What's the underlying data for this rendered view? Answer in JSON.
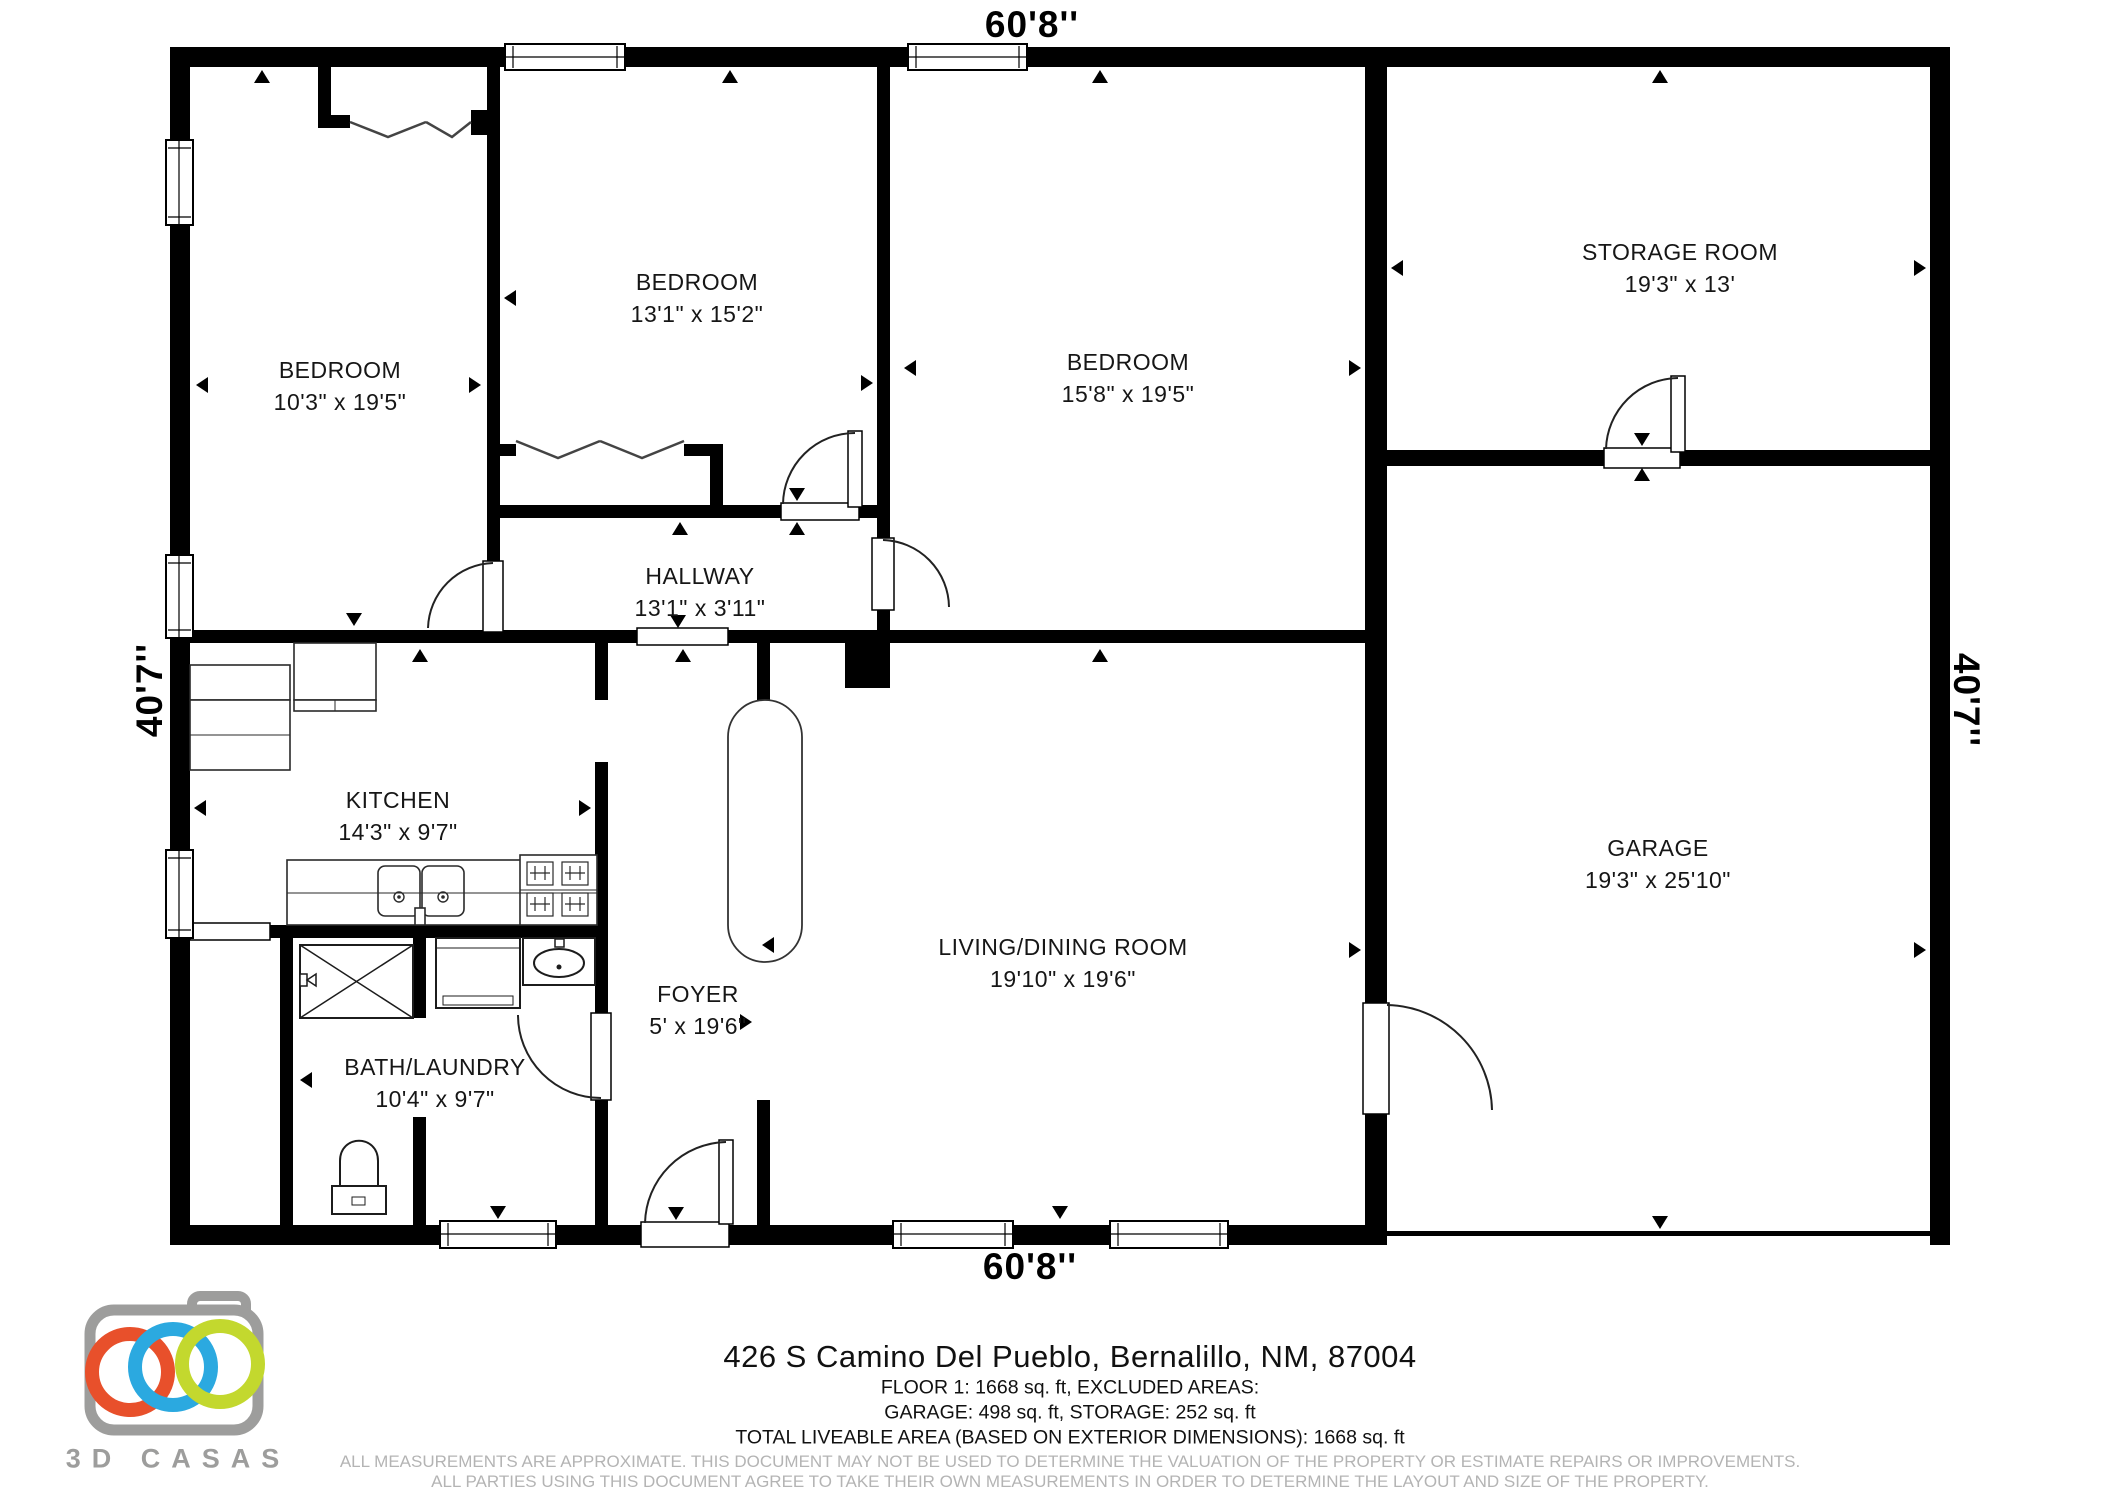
{
  "dimensions": {
    "top": "60'8''",
    "bottom": "60'8''",
    "left": "40'7''",
    "right": "40'7''"
  },
  "rooms": [
    {
      "name": "BEDROOM",
      "dims": "10'3\" x 19'5\""
    },
    {
      "name": "BEDROOM",
      "dims": "13'1\" x 15'2\""
    },
    {
      "name": "BEDROOM",
      "dims": "15'8\" x 19'5\""
    },
    {
      "name": "STORAGE ROOM",
      "dims": "19'3\" x 13'"
    },
    {
      "name": "HALLWAY",
      "dims": "13'1\" x 3'11\""
    },
    {
      "name": "KITCHEN",
      "dims": "14'3\" x 9'7\""
    },
    {
      "name": "FOYER",
      "dims": "5' x 19'6\""
    },
    {
      "name": "LIVING/DINING ROOM",
      "dims": "19'10\" x 19'6\""
    },
    {
      "name": "GARAGE",
      "dims": "19'3\" x 25'10\""
    },
    {
      "name": "BATH/LAUNDRY",
      "dims": "10'4\" x 9'7\""
    }
  ],
  "footer": {
    "address": "426 S Camino Del Pueblo, Bernalillo, NM, 87004",
    "area_line1": "FLOOR 1: 1668 sq. ft, EXCLUDED AREAS:",
    "area_line2": "GARAGE: 498 sq. ft, STORAGE: 252 sq. ft",
    "area_line3": "TOTAL LIVEABLE AREA (BASED ON EXTERIOR DIMENSIONS): 1668 sq. ft",
    "disclaimer1": "ALL MEASUREMENTS ARE APPROXIMATE. THIS DOCUMENT MAY NOT BE USED TO DETERMINE THE VALUATION OF THE PROPERTY OR ESTIMATE REPAIRS OR IMPROVEMENTS.",
    "disclaimer2": "ALL PARTIES USING THIS DOCUMENT AGREE TO TAKE THEIR OWN MEASUREMENTS IN ORDER TO DETERMINE THE LAYOUT AND SIZE OF THE PROPERTY."
  },
  "logo": {
    "text": "3D CASAS",
    "colors": {
      "camera_gray": "#9d9d9c",
      "ring_orange": "#E8502B",
      "ring_blue": "#2BA9E0",
      "ring_green": "#C3D82E"
    }
  }
}
